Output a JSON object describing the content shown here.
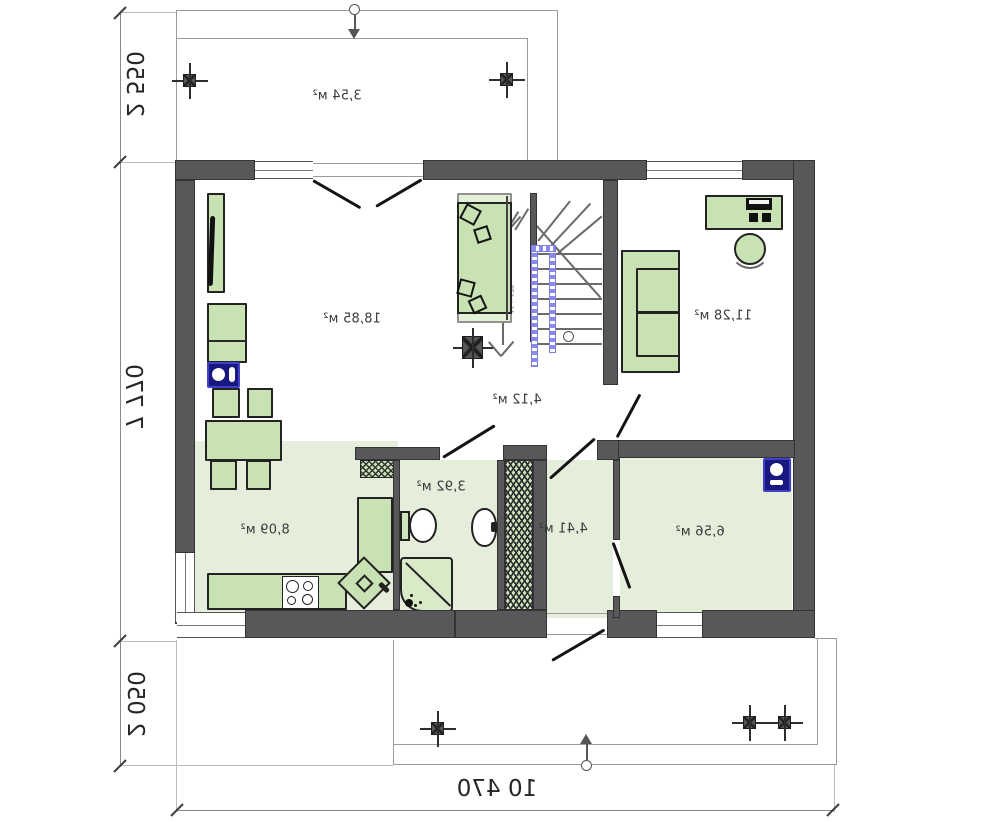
{
  "plan": {
    "title": "ground floor plan",
    "room_labels": {
      "terrace_top": "3,54 м²",
      "living": "18,85 м²",
      "bedroom": "11,28 м²",
      "hall_center": "4,12 м²",
      "kitchen": "8,09 м²",
      "bathroom": "3,92 м²",
      "hall_lower": "4,41 м²",
      "boiler": "6,56 м²"
    },
    "dimensions": {
      "terrace_top_depth": "2 550",
      "house_depth": "7 770",
      "terrace_bottom_depth": "2 050",
      "house_width": "10 470"
    },
    "stairs": {
      "spec": "16 х 178"
    },
    "colors": {
      "wall": "#58585a",
      "floor_green": "#e4eeda",
      "furniture_green": "#c9e2b3",
      "appliance_blue": "#181880",
      "railing_blue": "#8a8aec"
    }
  }
}
